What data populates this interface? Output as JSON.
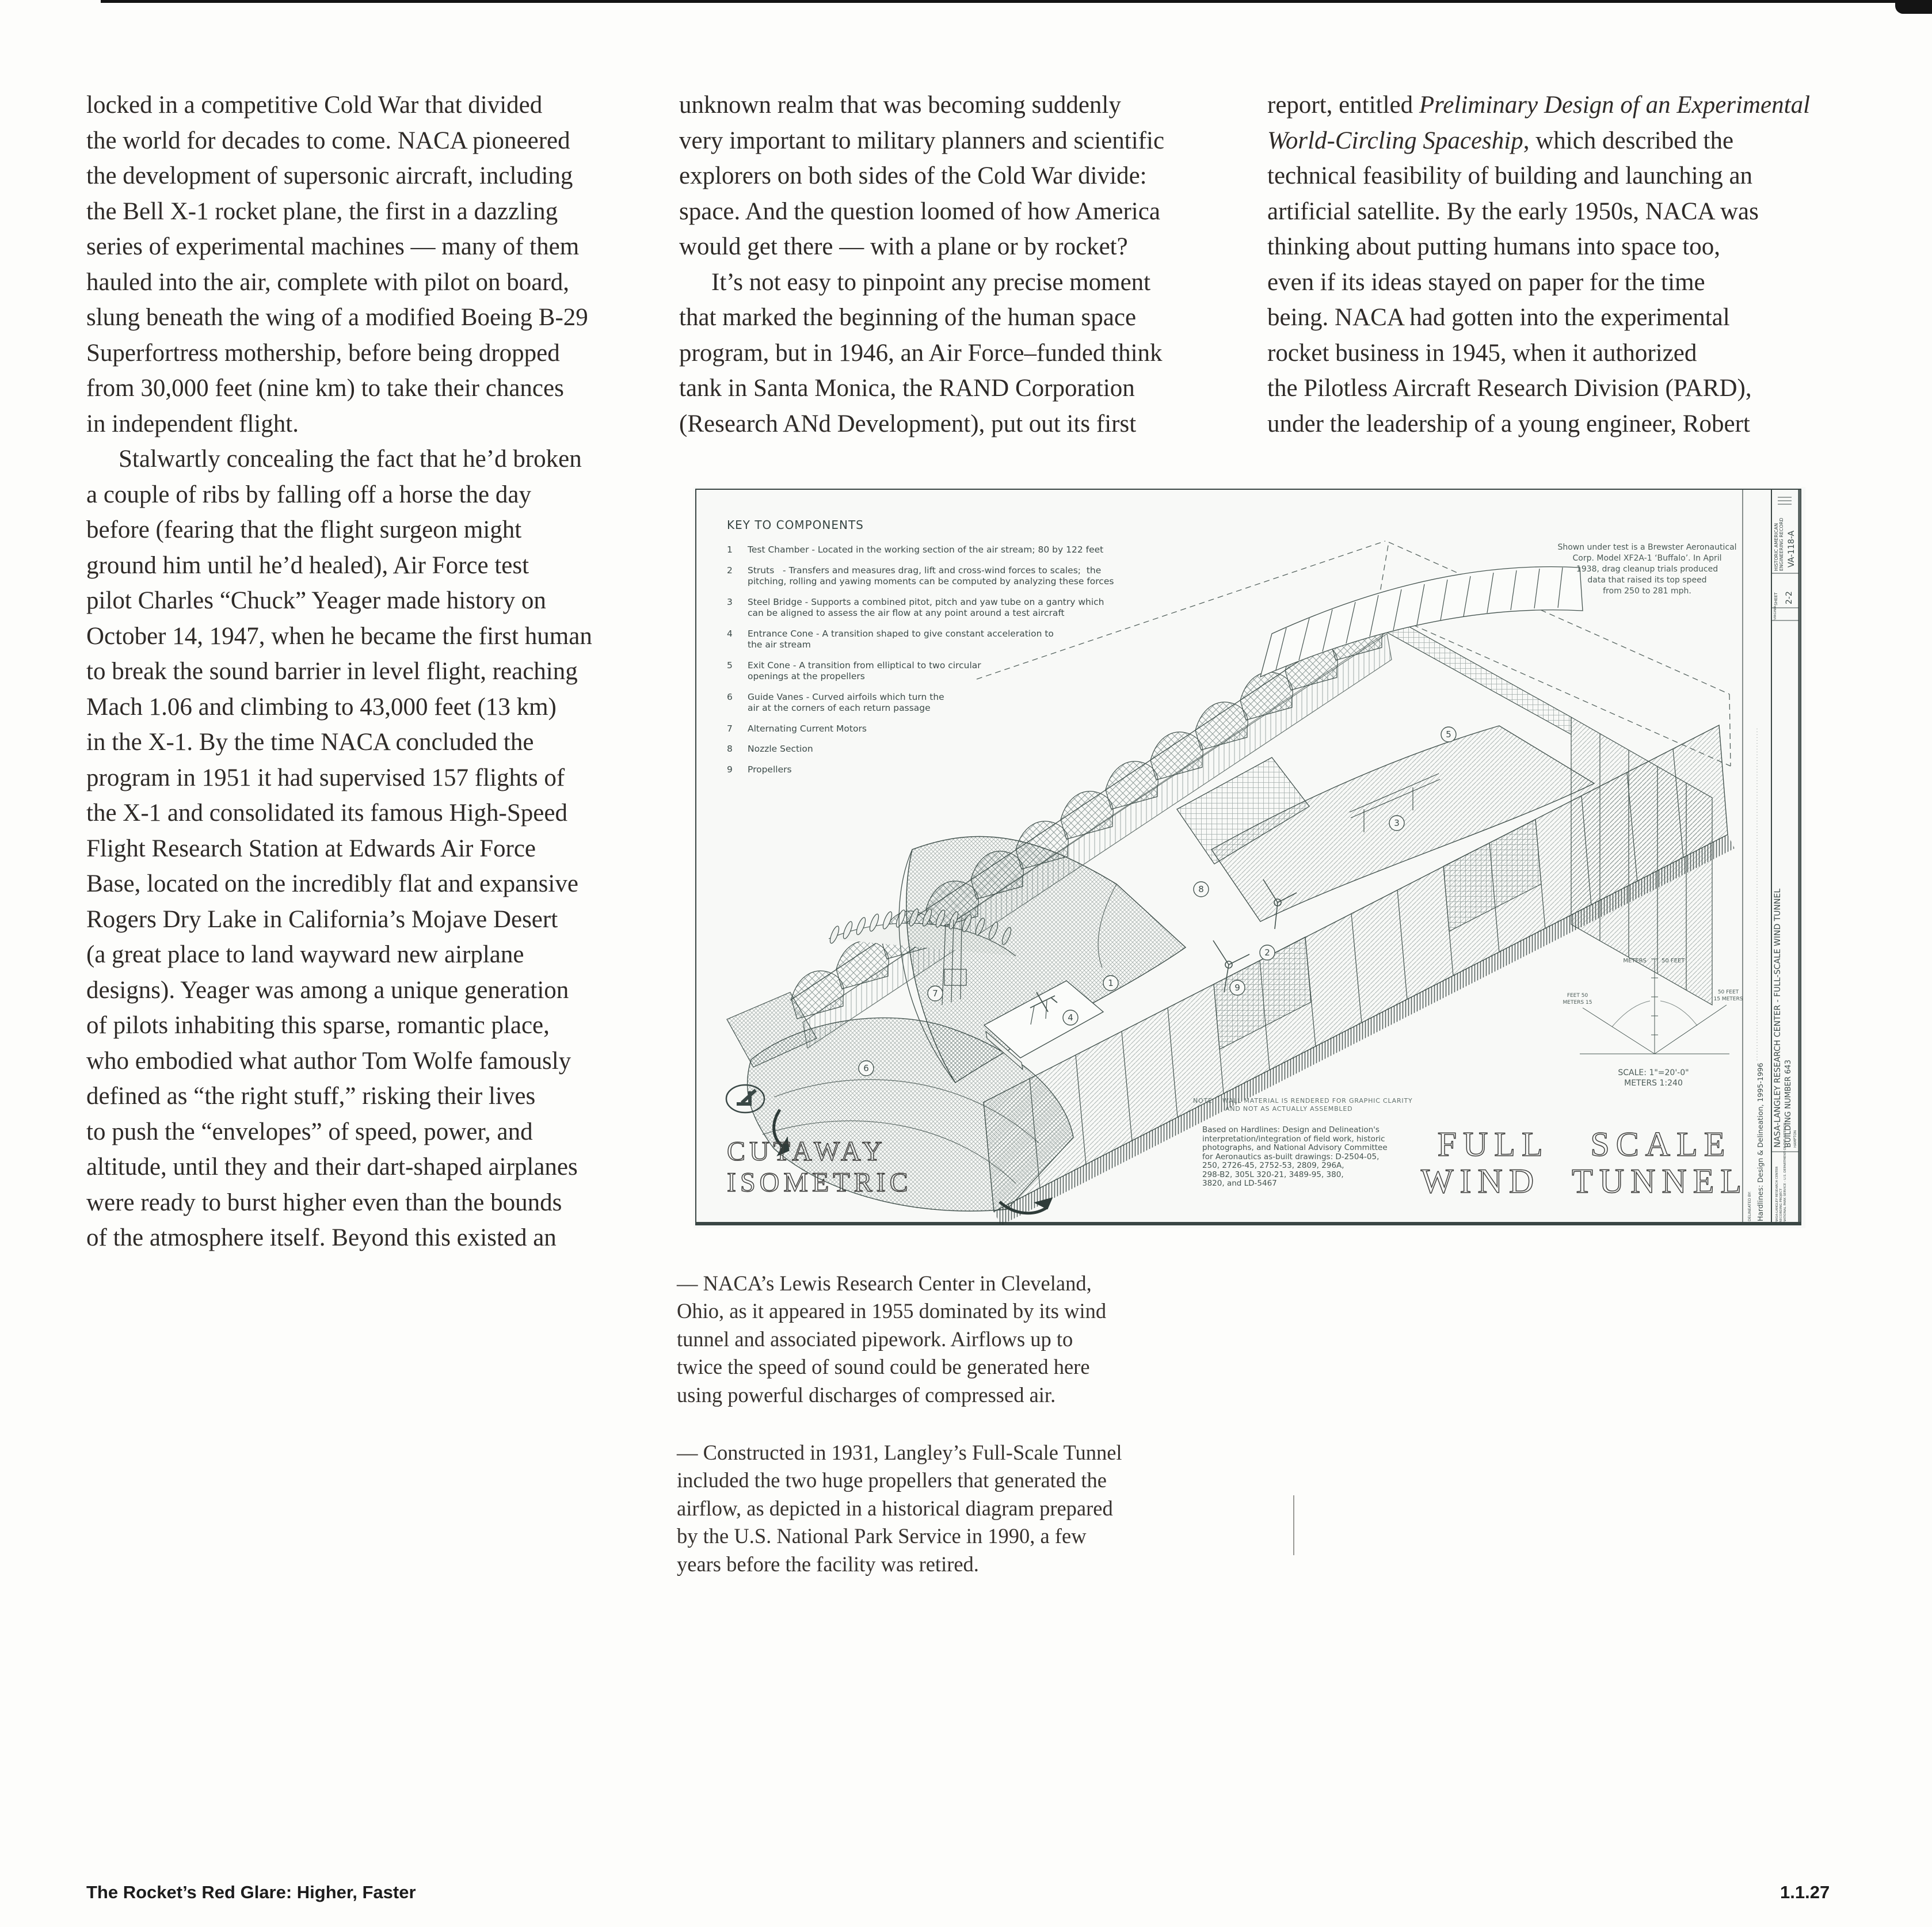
{
  "colors": {
    "ink": "#3c4a48",
    "paper": "#f8f9f7",
    "body_text": "#2f2b28"
  },
  "columns": {
    "left": [
      "locked in a competitive Cold War that divided",
      "the world for decades to come. NACA pioneered",
      "the development of supersonic aircraft, including",
      "the Bell X-1 rocket plane, the first in a dazzling",
      "series of experimental machines — many of them",
      "hauled into the air, complete with pilot on board,",
      "slung beneath the wing of a modified Boeing B-29",
      "Superfortress mothership, before being dropped",
      "from 30,000 feet (nine km) to take their chances",
      "in independent flight.",
      {
        "ind": true,
        "s": [
          {
            "t": "Stalwartly concealing the fact that he’d broken"
          }
        ]
      },
      "a couple of ribs by falling off a horse the day",
      "before (fearing that the flight surgeon might",
      "ground him until he’d healed), Air Force test",
      "pilot Charles “Chuck” Yeager made history on",
      "October 14, 1947, when he became the first human",
      "to break the sound barrier in level flight, reaching",
      "Mach 1.06 and climbing to 43,000 feet (13 km)",
      "in the X-1. By the time NACA concluded the",
      "program in 1951 it had supervised 157 flights of",
      "the X-1 and consolidated its famous High-Speed",
      "Flight Research Station at Edwards Air Force",
      "Base, located on the incredibly flat and expansive",
      "Rogers Dry Lake in California’s Mojave Desert",
      "(a great place to land wayward new airplane",
      "designs). Yeager was among a unique generation",
      "of pilots inhabiting this sparse, romantic place,",
      "who embodied what author Tom Wolfe famously",
      "defined as “the right stuff,” risking their lives",
      "to push the “envelopes” of speed, power, and",
      "altitude, until they and their dart-shaped airplanes",
      "were ready to burst higher even than the bounds",
      "of the atmosphere itself. Beyond this existed an"
    ],
    "middle": [
      "unknown realm that was becoming suddenly",
      "very important to military planners and scientific",
      "explorers on both sides of the Cold War divide:",
      "space. And the question loomed of how America",
      "would get there — with a plane or by rocket?",
      {
        "ind": true,
        "s": [
          {
            "t": "It’s not easy to pinpoint any precise moment"
          }
        ]
      },
      "that marked the beginning of the human space",
      "program, but in 1946, an Air Force–funded think",
      "tank in Santa Monica, the RAND Corporation",
      "(Research ANd Development), put out its first"
    ],
    "right": [
      {
        "s": [
          {
            "t": "report, entitled "
          },
          {
            "t": "Preliminary Design of an Experimental",
            "i": true
          }
        ]
      },
      {
        "s": [
          {
            "t": "World-Circling Spaceship",
            "i": true
          },
          {
            "t": ", which described the"
          }
        ]
      },
      "technical feasibility of building and launching an",
      "artificial satellite. By the early 1950s, NACA was",
      "thinking about putting humans into space too,",
      "even if its ideas stayed on paper for the time",
      "being. NACA had gotten into the experimental",
      "rocket business in 1945, when it authorized",
      "the Pilotless Aircraft Research Division (PARD),",
      "under the leadership of a young engineer, Robert"
    ]
  },
  "captions": [
    {
      "lines": [
        "— NACA’s Lewis Research Center in Cleveland,",
        "Ohio, as it appeared in 1955 dominated by its wind",
        "tunnel and associated pipework. Airflows up to",
        "twice the speed of sound could be generated here",
        "using powerful discharges of compressed air."
      ]
    },
    {
      "lines": [
        "— Constructed in 1931, Langley’s Full-Scale Tunnel",
        "included the two huge propellers that generated the",
        "airflow, as depicted in a historical diagram prepared",
        "by the U.S. National Park Service in 1990, a few",
        "years before the facility was retired."
      ]
    }
  ],
  "diagram": {
    "key_title": "KEY TO COMPONENTS",
    "key_items": [
      {
        "num": "1",
        "lines": [
          "Test Chamber - Located in the working section of the air stream; 80 by 122 feet"
        ]
      },
      {
        "num": "2",
        "lines": [
          "Struts   - Transfers and measures drag, lift and cross-wind forces to scales;  the",
          "pitching, rolling and yawing moments can be computed by analyzing these forces"
        ]
      },
      {
        "num": "3",
        "lines": [
          "Steel Bridge - Supports a combined pitot, pitch and yaw tube on a gantry which",
          "can be aligned to assess the air flow at any point around a test aircraft"
        ]
      },
      {
        "num": "4",
        "lines": [
          "Entrance Cone - A transition shaped to give constant acceleration to",
          "the air stream"
        ]
      },
      {
        "num": "5",
        "lines": [
          "Exit Cone - A transition from elliptical to two circular",
          "openings at the propellers"
        ]
      },
      {
        "num": "6",
        "lines": [
          "Guide Vanes - Curved airfoils which turn the",
          "air at the corners of each return passage"
        ]
      },
      {
        "num": "7",
        "lines": [
          "Alternating Current Motors"
        ]
      },
      {
        "num": "8",
        "lines": [
          "Nozzle Section"
        ]
      },
      {
        "num": "9",
        "lines": [
          "Propellers"
        ]
      }
    ],
    "annotation_lines": [
      "Shown under test is a Brewster Aeronautical",
      "Corp. Model XF2A-1 ‘Buffalo’. In April",
      "1938, drag cleanup trials produced",
      "data that raised its top speed",
      "from 250 to 281 mph."
    ],
    "note_lines": [
      "NOTE    WALL MATERIAL IS RENDERED FOR GRAPHIC CLARITY",
      "AND NOT AS ACTUALLY ASSEMBLED"
    ],
    "based_lines": [
      "Based on Hardlines: Design and Delineation's",
      "interpretation/integration of field work, historic",
      "photographs, and National Advisory Committee",
      "for Aeronautics as-built drawings: D-2504-05,",
      "250, 2726-45, 2752-53, 2809, 296A,",
      "298-B2, 305L 320-21, 3489-95, 380,",
      "3820, and LD-5467"
    ],
    "cutaway_title_1": "CUTAWAY",
    "cutaway_title_2": "ISOMETRIC",
    "big_title_1": "FULL SCALE",
    "big_title_2": "WIND TUNNEL",
    "callouts": [
      "1",
      "2",
      "3",
      "4",
      "5",
      "6",
      "7",
      "8",
      "9"
    ],
    "scale": {
      "meters": "METERS",
      "feet_top": "50 FEET",
      "left_1": "FEET 50",
      "left_2": "METERS 15",
      "right_1": "50 FEET",
      "right_2": "15 METERS",
      "caption_1": "SCALE: 1\"=20'-0\"",
      "caption_2": "METERS 1:240"
    },
    "titleblock": {
      "haer_1": "HISTORIC AMERICAN",
      "haer_2": "ENGINEERING RECORD",
      "haer_id": "VA-118-A",
      "sheet_label": "SHEET",
      "sheet_num": "2-2",
      "state": "VIRGINIA",
      "main_title": "NASA-LANGLEY RESEARCH CENTER - FULL-SCALE WIND TUNNEL",
      "building": "BUILDING NUMBER 643",
      "city": "HAMPTON",
      "delineated_label": "DELINEATED BY:",
      "delineator": "Hardlines: Design & Delineation, 1995-1996",
      "credit_1": "NASA-LANGLEY RESEARCH CENTER",
      "credit_2": "RECORDING PROJECT",
      "credit_3": "NATIONAL PARK SERVICE - U.S. DEPARTMENT OF THE INTERIOR"
    }
  },
  "footer": {
    "left": "The Rocket’s Red Glare: Higher, Faster",
    "right": "1.1.27"
  }
}
